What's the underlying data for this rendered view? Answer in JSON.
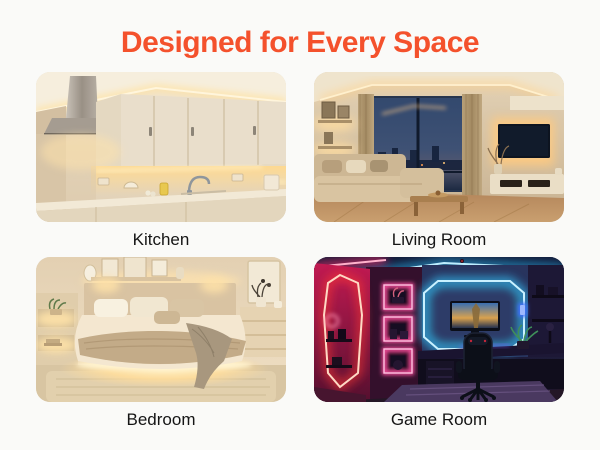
{
  "title": {
    "text": "Designed for Every Space",
    "color": "#f4512c"
  },
  "cards": [
    {
      "id": "kitchen",
      "label": "Kitchen"
    },
    {
      "id": "living-room",
      "label": "Living Room"
    },
    {
      "id": "bedroom",
      "label": "Bedroom"
    },
    {
      "id": "game-room",
      "label": "Game Room"
    }
  ],
  "colors": {
    "page_background": "#fafaf8",
    "accent": "#f4512c",
    "caption_text": "#151515",
    "warm_led_glow": "#ffd88e",
    "neon_pink": "#ff3d7a",
    "neon_blue": "#35c8ff",
    "neon_red_orange": "#ff5a3c"
  }
}
